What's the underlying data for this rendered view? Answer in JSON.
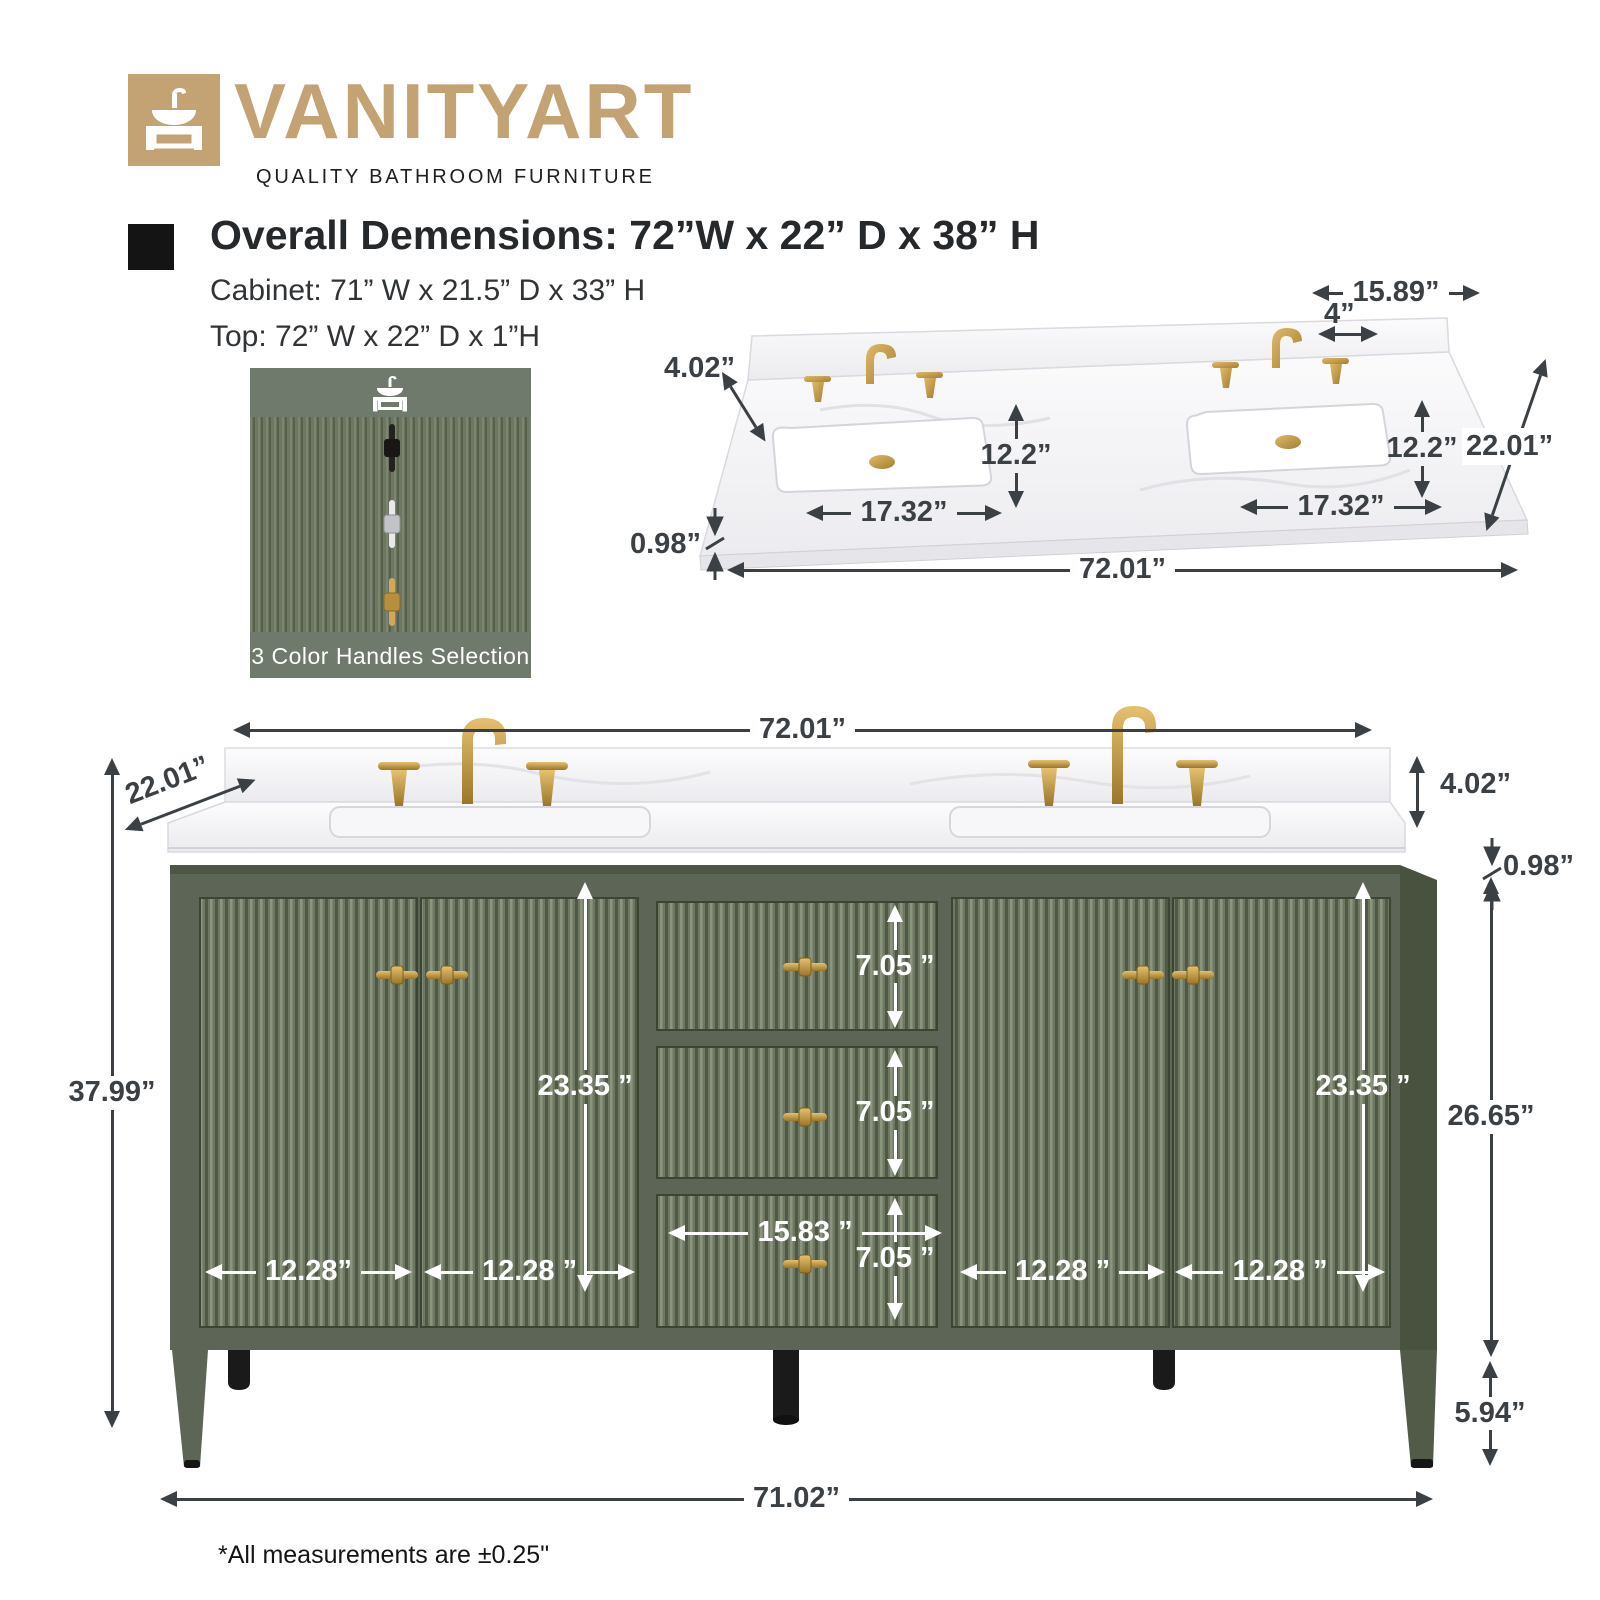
{
  "brand": {
    "name": "VANITYART",
    "tagline": "QUALITY BATHROOM FURNITURE"
  },
  "specs": {
    "overall": "Overall Demensions: 72”W x 22” D x 38” H",
    "cabinet": "Cabinet: 71” W x 21.5” D x 33” H",
    "top": "Top: 72” W x 22” D x 1”H"
  },
  "handles_box": {
    "caption": "3 Color Handles Selection",
    "options": [
      "black",
      "chrome",
      "gold"
    ]
  },
  "top_diagram": {
    "back_width": "15.89”",
    "faucet_spread": "4”",
    "splash_height": "4.02”",
    "sink_depth_left": "12.2”",
    "sink_depth_right": "12.2”",
    "depth": "22.01”",
    "sink_width_left": "17.32”",
    "sink_width_right": "17.32”",
    "top_thickness": "0.98”",
    "full_width": "72.01”"
  },
  "front_diagram": {
    "full_width": "72.01”",
    "depth": "22.01”",
    "splash_height": "4.02”",
    "top_thickness": "0.98”",
    "overall_height": "37.99”",
    "door_col_left_height": "23.35 ”",
    "door_col_right_height": "23.35 ”",
    "body_height": "26.65”",
    "drawer1_height": "7.05 ”",
    "drawer2_height": "7.05 ”",
    "drawer3_height": "7.05 ”",
    "drawer_width": "15.83 ”",
    "door1_width": "12.28”",
    "door2_width": "12.28 ”",
    "door3_width": "12.28 ”",
    "door4_width": "12.28 ”",
    "leg_height": "5.94”",
    "base_width": "71.02”"
  },
  "footnote": "*All measurements are ±0.25\"",
  "colors": {
    "brand_gold": "#c3a274",
    "cabinet_green": "#5d6656",
    "flute_light": "#7b856f",
    "flute_dark": "#57614c",
    "hardware_gold": "#c5a055",
    "dimension_ink": "#3a4044",
    "marble": "#f5f5f7",
    "feet_black": "#1a1a1a"
  }
}
